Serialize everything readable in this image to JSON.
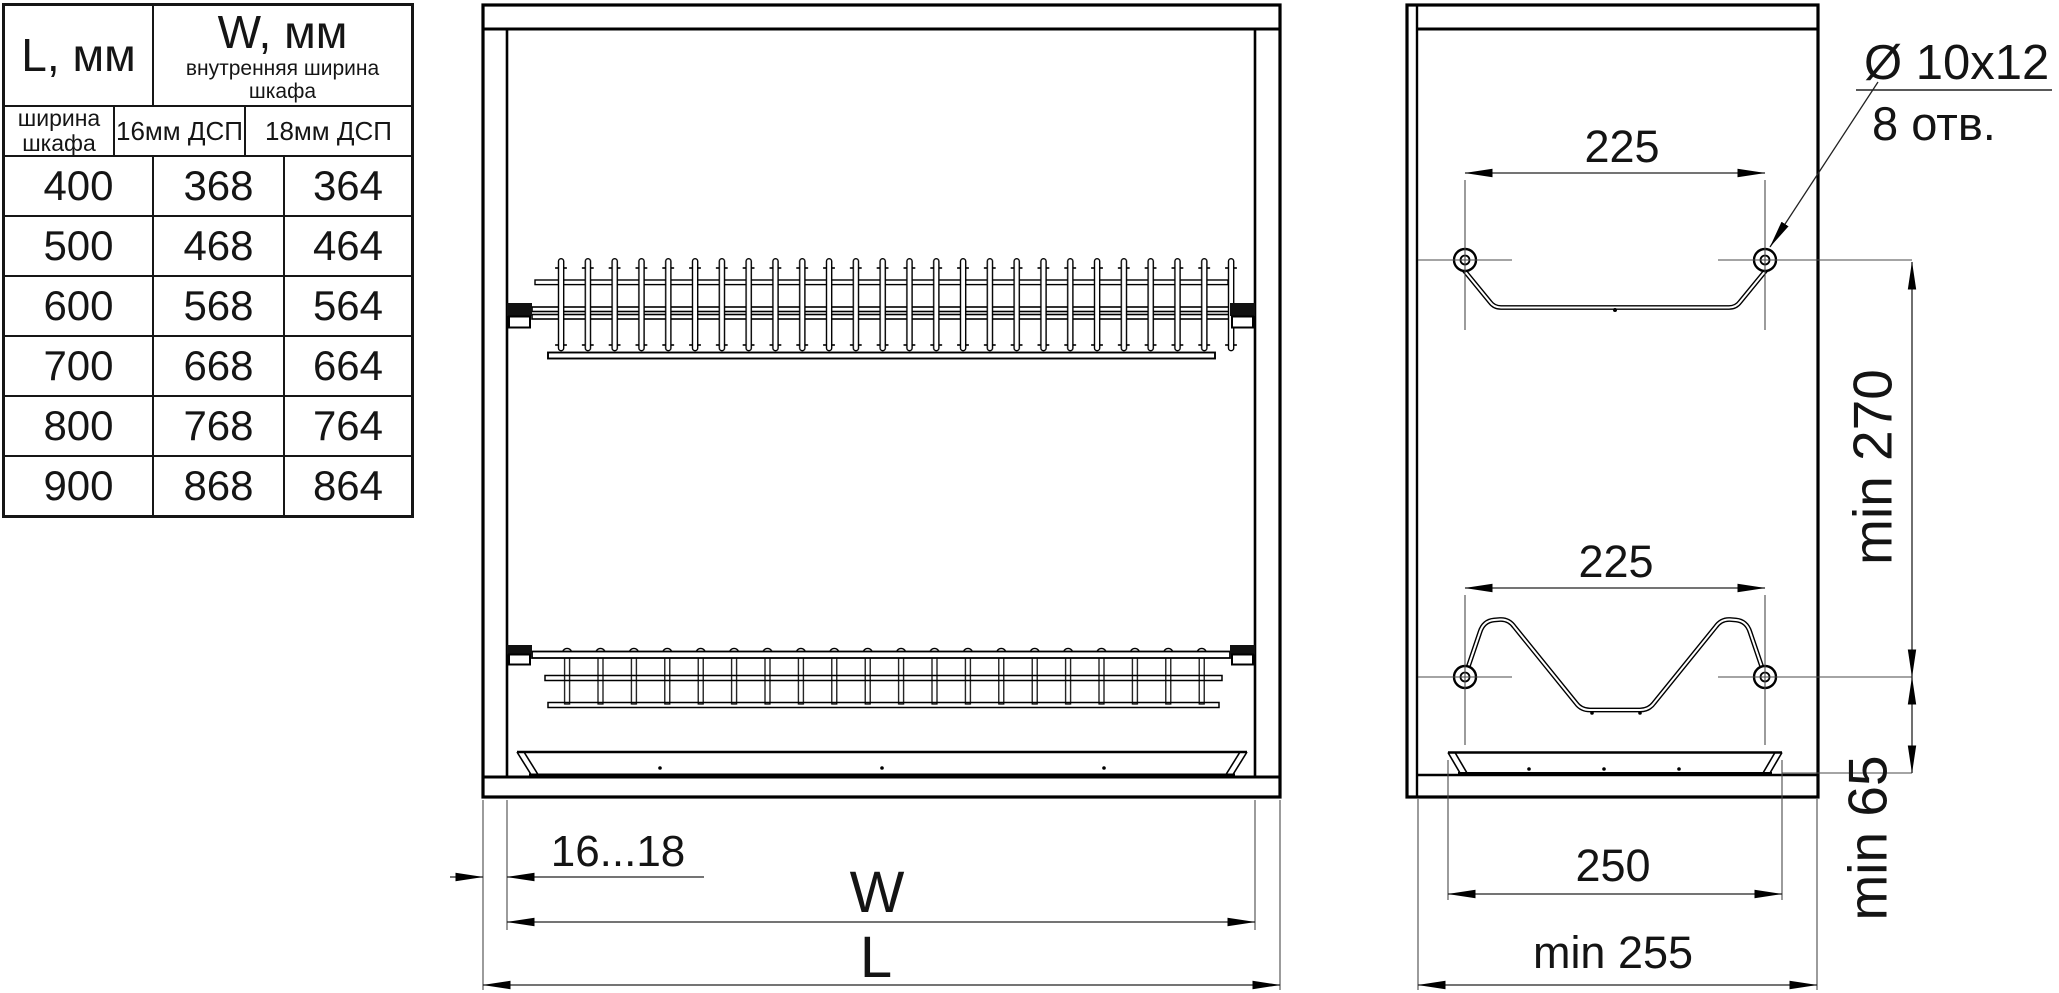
{
  "table": {
    "col1_header": "L, мм",
    "col2_header": "W, мм",
    "col2_subtitle": "внутренняя ширина шкафа",
    "sub_headers": [
      "ширина шкафа",
      "16мм ДСП",
      "18мм ДСП"
    ],
    "rows": [
      [
        "400",
        "368",
        "364"
      ],
      [
        "500",
        "468",
        "464"
      ],
      [
        "600",
        "568",
        "564"
      ],
      [
        "700",
        "668",
        "664"
      ],
      [
        "800",
        "768",
        "764"
      ],
      [
        "900",
        "868",
        "864"
      ]
    ]
  },
  "front_view": {
    "wall_thickness": "16...18",
    "inner_width_label": "W",
    "outer_width_label": "L"
  },
  "side_view": {
    "top_hole_span": "225",
    "bottom_hole_span": "225",
    "hole_spec": "Ø 10x12",
    "hole_count": "8 отв.",
    "min_height": "min 270",
    "min_clearance": "min 65",
    "tray_width": "250",
    "min_depth": "min 255"
  },
  "colors": {
    "line": "#000000",
    "dim_line": "#3c3c3c",
    "background": "#ffffff"
  }
}
